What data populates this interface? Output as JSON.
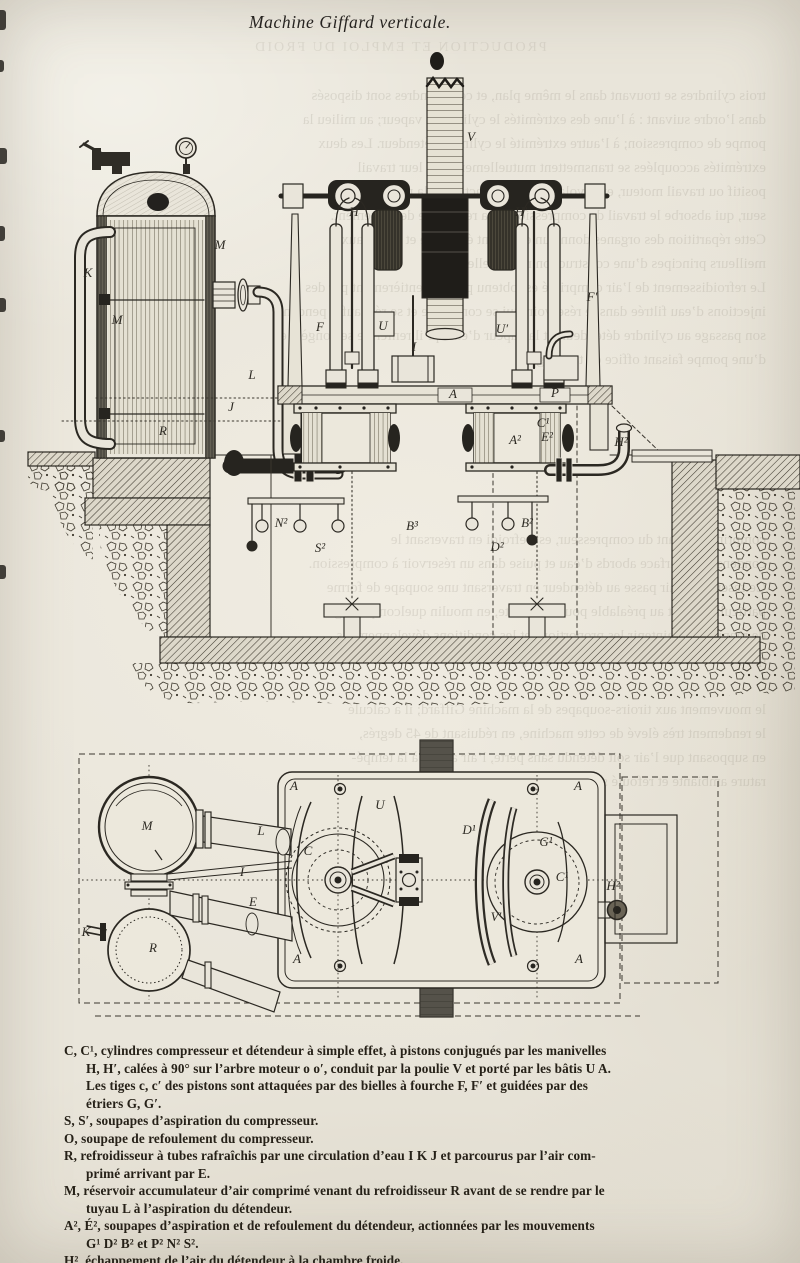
{
  "page": {
    "title": "Machine Giffard verticale."
  },
  "colors": {
    "paper": "#e9e5da",
    "ink": "#2b2822",
    "dark_ink": "#26241f",
    "ghost": "#6e6758"
  },
  "legend": {
    "lines": [
      {
        "cont": false,
        "text": "C, C¹, cylindres compresseur et détendeur à simple effet, à pistons conjugués par les manivelles"
      },
      {
        "cont": true,
        "text": "H, H′, calées à 90° sur l’arbre moteur o o′, conduit par la poulie V et porté par les bâtis U A."
      },
      {
        "cont": true,
        "text": "Les tiges c, c′ des pistons sont attaquées par des bielles à fourche F, F′ et guidées par des"
      },
      {
        "cont": true,
        "text": "étriers G, G′."
      },
      {
        "cont": false,
        "text": "S, S′, soupapes d’aspiration du compresseur."
      },
      {
        "cont": false,
        "text": "O, soupape de refoulement du compresseur."
      },
      {
        "cont": false,
        "text": "R, refroidisseur à tubes rafraîchis par une circulation d’eau I K J et parcourus par l’air com-"
      },
      {
        "cont": true,
        "text": "primé arrivant par E."
      },
      {
        "cont": false,
        "text": "M, réservoir accumulateur d’air comprimé venant du refroidisseur R avant de se rendre par le"
      },
      {
        "cont": true,
        "text": "tuyau L à l’aspiration du détendeur."
      },
      {
        "cont": false,
        "text": "A², É², soupapes d’aspiration et de refoulement du détendeur, actionnées par les mouvements"
      },
      {
        "cont": true,
        "text": "G¹ D² B² et P² N² S²."
      },
      {
        "cont": false,
        "text": "H², échappement de l’air du détendeur à la chambre froide."
      }
    ]
  },
  "elevation": {
    "labels": [
      {
        "t": "M",
        "x": 220,
        "y": 249
      },
      {
        "t": "K",
        "x": 88,
        "y": 277
      },
      {
        "t": "M",
        "x": 117,
        "y": 324
      },
      {
        "t": "R",
        "x": 163,
        "y": 435
      },
      {
        "t": "L",
        "x": 252,
        "y": 379
      },
      {
        "t": "J",
        "x": 231,
        "y": 411
      },
      {
        "t": "V",
        "x": 471,
        "y": 141
      },
      {
        "t": "H",
        "x": 354,
        "y": 216
      },
      {
        "t": "H′",
        "x": 521,
        "y": 216
      },
      {
        "t": "U",
        "x": 383,
        "y": 330
      },
      {
        "t": "U′",
        "x": 502,
        "y": 333
      },
      {
        "t": "F",
        "x": 320,
        "y": 331
      },
      {
        "t": "F′",
        "x": 592,
        "y": 301
      },
      {
        "t": "I",
        "x": 414,
        "y": 351
      },
      {
        "t": "A",
        "x": 453,
        "y": 398
      },
      {
        "t": "P",
        "x": 555,
        "y": 397
      },
      {
        "t": "C¹",
        "x": 543,
        "y": 427
      },
      {
        "t": "A²",
        "x": 515,
        "y": 444
      },
      {
        "t": "E²",
        "x": 547,
        "y": 441
      },
      {
        "t": "H²",
        "x": 621,
        "y": 446
      },
      {
        "t": "B³",
        "x": 412,
        "y": 530
      },
      {
        "t": "N²",
        "x": 281,
        "y": 527
      },
      {
        "t": "S²",
        "x": 320,
        "y": 552
      },
      {
        "t": "D²",
        "x": 497,
        "y": 551
      },
      {
        "t": "B²",
        "x": 527,
        "y": 527
      }
    ]
  },
  "plan": {
    "pulley_box_label": "V",
    "labels": [
      {
        "t": "M",
        "x": 147,
        "y": 830
      },
      {
        "t": "R",
        "x": 153,
        "y": 952
      },
      {
        "t": "K",
        "x": 86,
        "y": 936
      },
      {
        "t": "L",
        "x": 261,
        "y": 835
      },
      {
        "t": "I",
        "x": 242,
        "y": 876
      },
      {
        "t": "E",
        "x": 253,
        "y": 906
      },
      {
        "t": "A",
        "x": 294,
        "y": 790
      },
      {
        "t": "A",
        "x": 297,
        "y": 963
      },
      {
        "t": "A",
        "x": 578,
        "y": 790
      },
      {
        "t": "A",
        "x": 579,
        "y": 963
      },
      {
        "t": "C",
        "x": 308,
        "y": 855
      },
      {
        "t": "U",
        "x": 380,
        "y": 809
      },
      {
        "t": "C¹",
        "x": 562,
        "y": 881
      },
      {
        "t": "G¹",
        "x": 546,
        "y": 846
      },
      {
        "t": "D¹",
        "x": 469,
        "y": 834
      },
      {
        "t": "V′",
        "x": 496,
        "y": 921
      },
      {
        "t": "H²",
        "x": 613,
        "y": 890
      }
    ]
  },
  "bleedthrough": {
    "blocks": [
      {
        "x": 70,
        "y": 36,
        "w": 660,
        "center": true,
        "lines": [
          "PRODUCTION ET EMPLOI DU FROID"
        ]
      },
      {
        "x": 60,
        "y": 84,
        "w": 706,
        "center": false,
        "lines": [
          "trois cylindres se trouvant dans le même plan, et ces cylindres sont disposés",
          "dans l’ordre suivant : à l’une des extrémités le cylindre à vapeur; au milieu la",
          "pompe de compression; à l’autre extrémité le cylindre détendeur. Les deux",
          "extrémités accouplées se transmettent mutuellement tout leur travail",
          "positif ou travail moteur, et le volant du milieu actionne la machine sec-",
          "seur, qui absorbe le travail de compression et la résistance de frottement.",
          "Cette répartition des organes donne un excellent équilibre et réunit aux",
          "meilleurs principes d’une construction rationnelle.",
          "Le refroidissement de l’air comprimé est obtenu presque entièrement par des",
          "injections d’eau filtrée dans le réservoir, qui se comprime et se réchauffe pendant",
          "son passage au cylindre détendeur, et la vapeur d’eau qu’il renferme se congèle en",
          "d’une pompe faisant office de tamisage."
        ]
      },
      {
        "x": 60,
        "y": 528,
        "w": 706,
        "center": false,
        "lines": [
          "comprimé, sortant du compresseur, est refroidi en traversant le",
          "condenseur à surface abords d’eau et puise dans un réservoir à compression.",
          "Ce réservoir, l’air passe au détendeur en traversant une soupape de forme",
          "particulièrement au préalable pour la détente, en moulin quelconque réglé",
          "de manière à maintenir les proportions et les conditions développemens",
          "qui donnent le rendement maximum, et par"
        ]
      },
      {
        "x": 60,
        "y": 698,
        "w": 706,
        "center": false,
        "lines": [
          "le mouvement aux tiroirs-soupapes de la machine Giffard; il a calculé",
          "le rendement très élevé de cette machine, en réduisant de 45 degrés,",
          "en supposant que l’air soit détendu sans perte, l’air aspiré à la tempé-",
          "rature ambiante et refoulé sous un vol p."
        ]
      }
    ]
  }
}
